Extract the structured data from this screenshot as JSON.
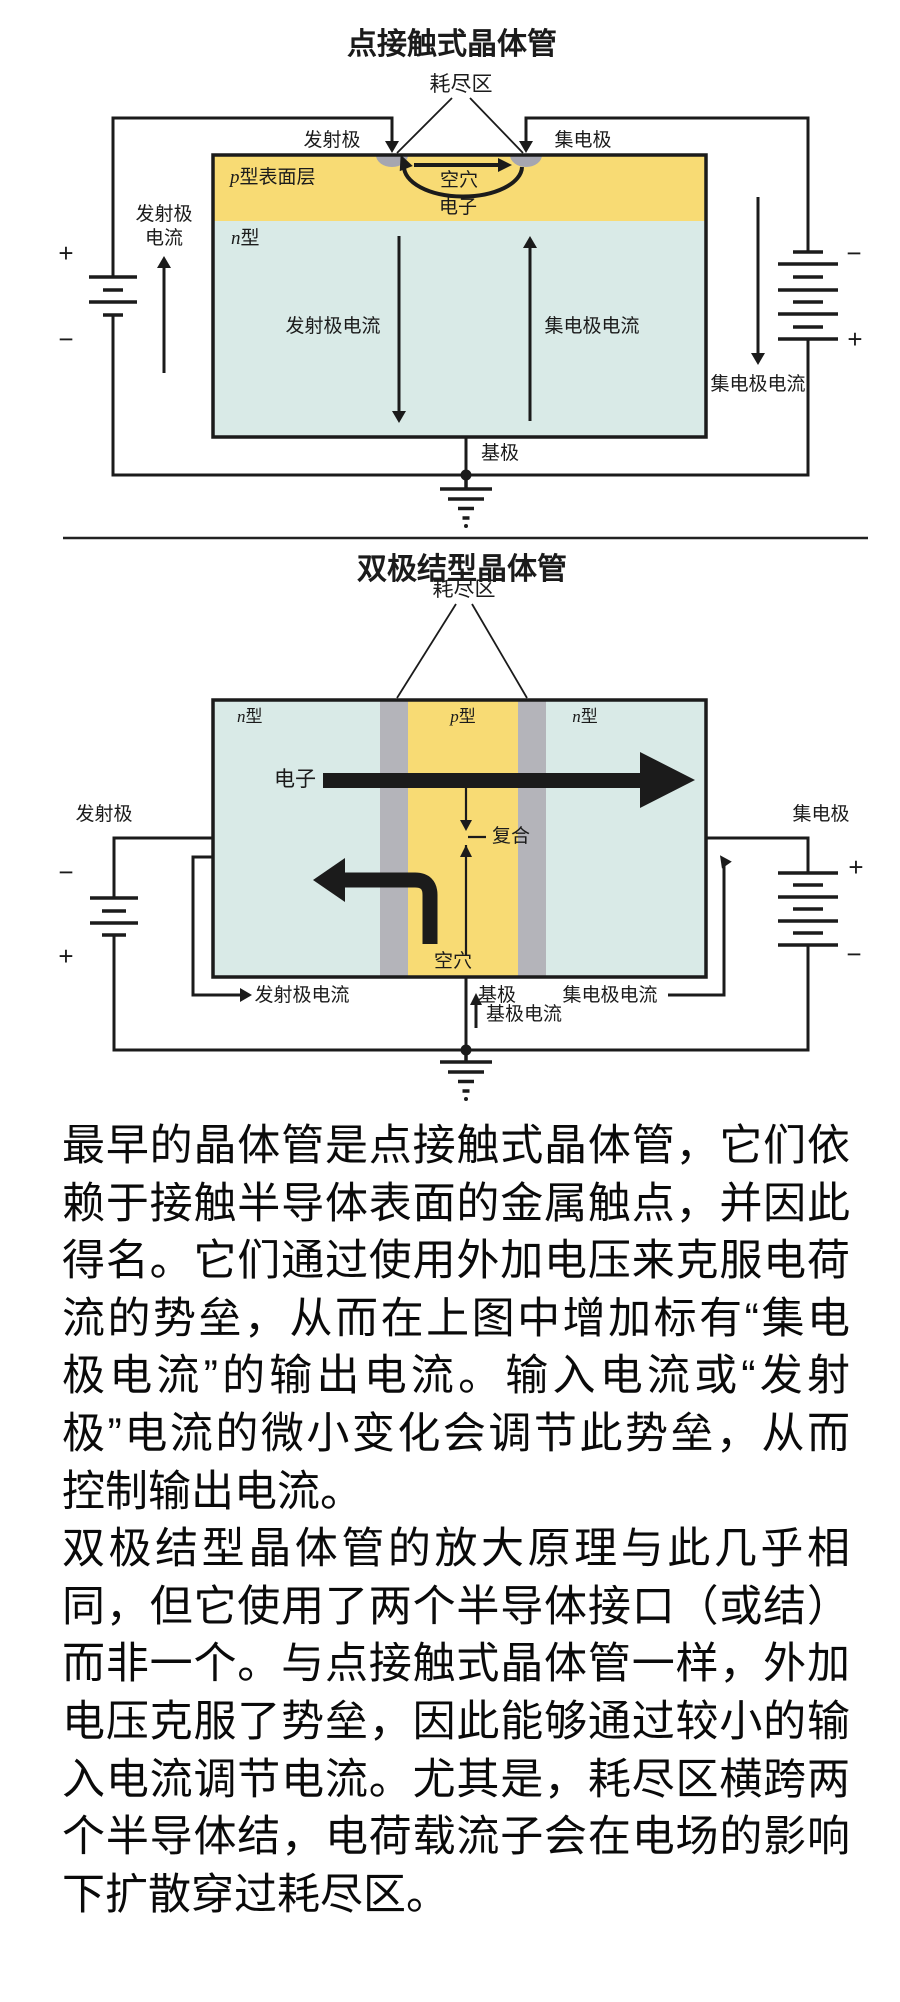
{
  "colors": {
    "p_region_yellow": "#F8DB74",
    "n_region_cyan": "#D9EAE7",
    "depletion_gray": "#B4B4BA",
    "contact_gray": "#A6A6B0",
    "line_black": "#1B1B1B"
  },
  "figure1": {
    "title": "点接触式晶体管",
    "depletion_label": "耗尽区",
    "emitter_label": "发射极",
    "collector_label": "集电极",
    "p_layer": {
      "letter": "p",
      "rest": "型表面层"
    },
    "n_layer": {
      "letter": "n",
      "rest": "型"
    },
    "holes_label": "空穴",
    "electrons_label": "电子",
    "emitter_current_inner": "发射极电流",
    "collector_current_inner": "集电极电流",
    "emitter_current_side_line1": "发射极",
    "emitter_current_side_line2": "电流",
    "collector_current_side": "集电极电流",
    "base_label": "基极",
    "battery_left_plus": "+",
    "battery_left_minus": "−",
    "battery_right_minus": "−",
    "battery_right_plus": "+"
  },
  "figure2": {
    "title": "双极结型晶体管",
    "depletion_label": "耗尽区",
    "n_left": {
      "letter": "n",
      "rest": "型"
    },
    "p_mid": {
      "letter": "p",
      "rest": "型"
    },
    "n_right": {
      "letter": "n",
      "rest": "型"
    },
    "electrons_label": "电子",
    "recombination_label": "复合",
    "holes_label": "空穴",
    "emitter_label": "发射极",
    "collector_label": "集电极",
    "emitter_current_label": "发射极电流",
    "base_label": "基极",
    "collector_current_label": "集电极电流",
    "base_current_label": "基极电流",
    "battery_left_minus": "−",
    "battery_left_plus": "+",
    "battery_right_plus": "+",
    "battery_right_minus": "−"
  },
  "article": {
    "lines": [
      "最早的晶体管是点接触式晶体管，它们依",
      "赖于接触半导体表面的金属触点，并因此",
      "得名。它们通过使用外加电压来克服电荷",
      "流的势垒，从而在上图中增加标有“集电",
      "极电流”的输出电流。输入电流或“发射",
      "极”电流的微小变化会调节此势垒，从而",
      "控制输出电流。",
      "双极结型晶体管的放大原理与此几乎相",
      "同，但它使用了两个半导体接口（或结）",
      "而非一个。与点接触式晶体管一样，外加",
      "电压克服了势垒，因此能够通过较小的输",
      "入电流调节电流。尤其是，耗尽区横跨两",
      "个半导体结，电荷载流子会在电场的影响",
      "下扩散穿过耗尽区。"
    ]
  }
}
